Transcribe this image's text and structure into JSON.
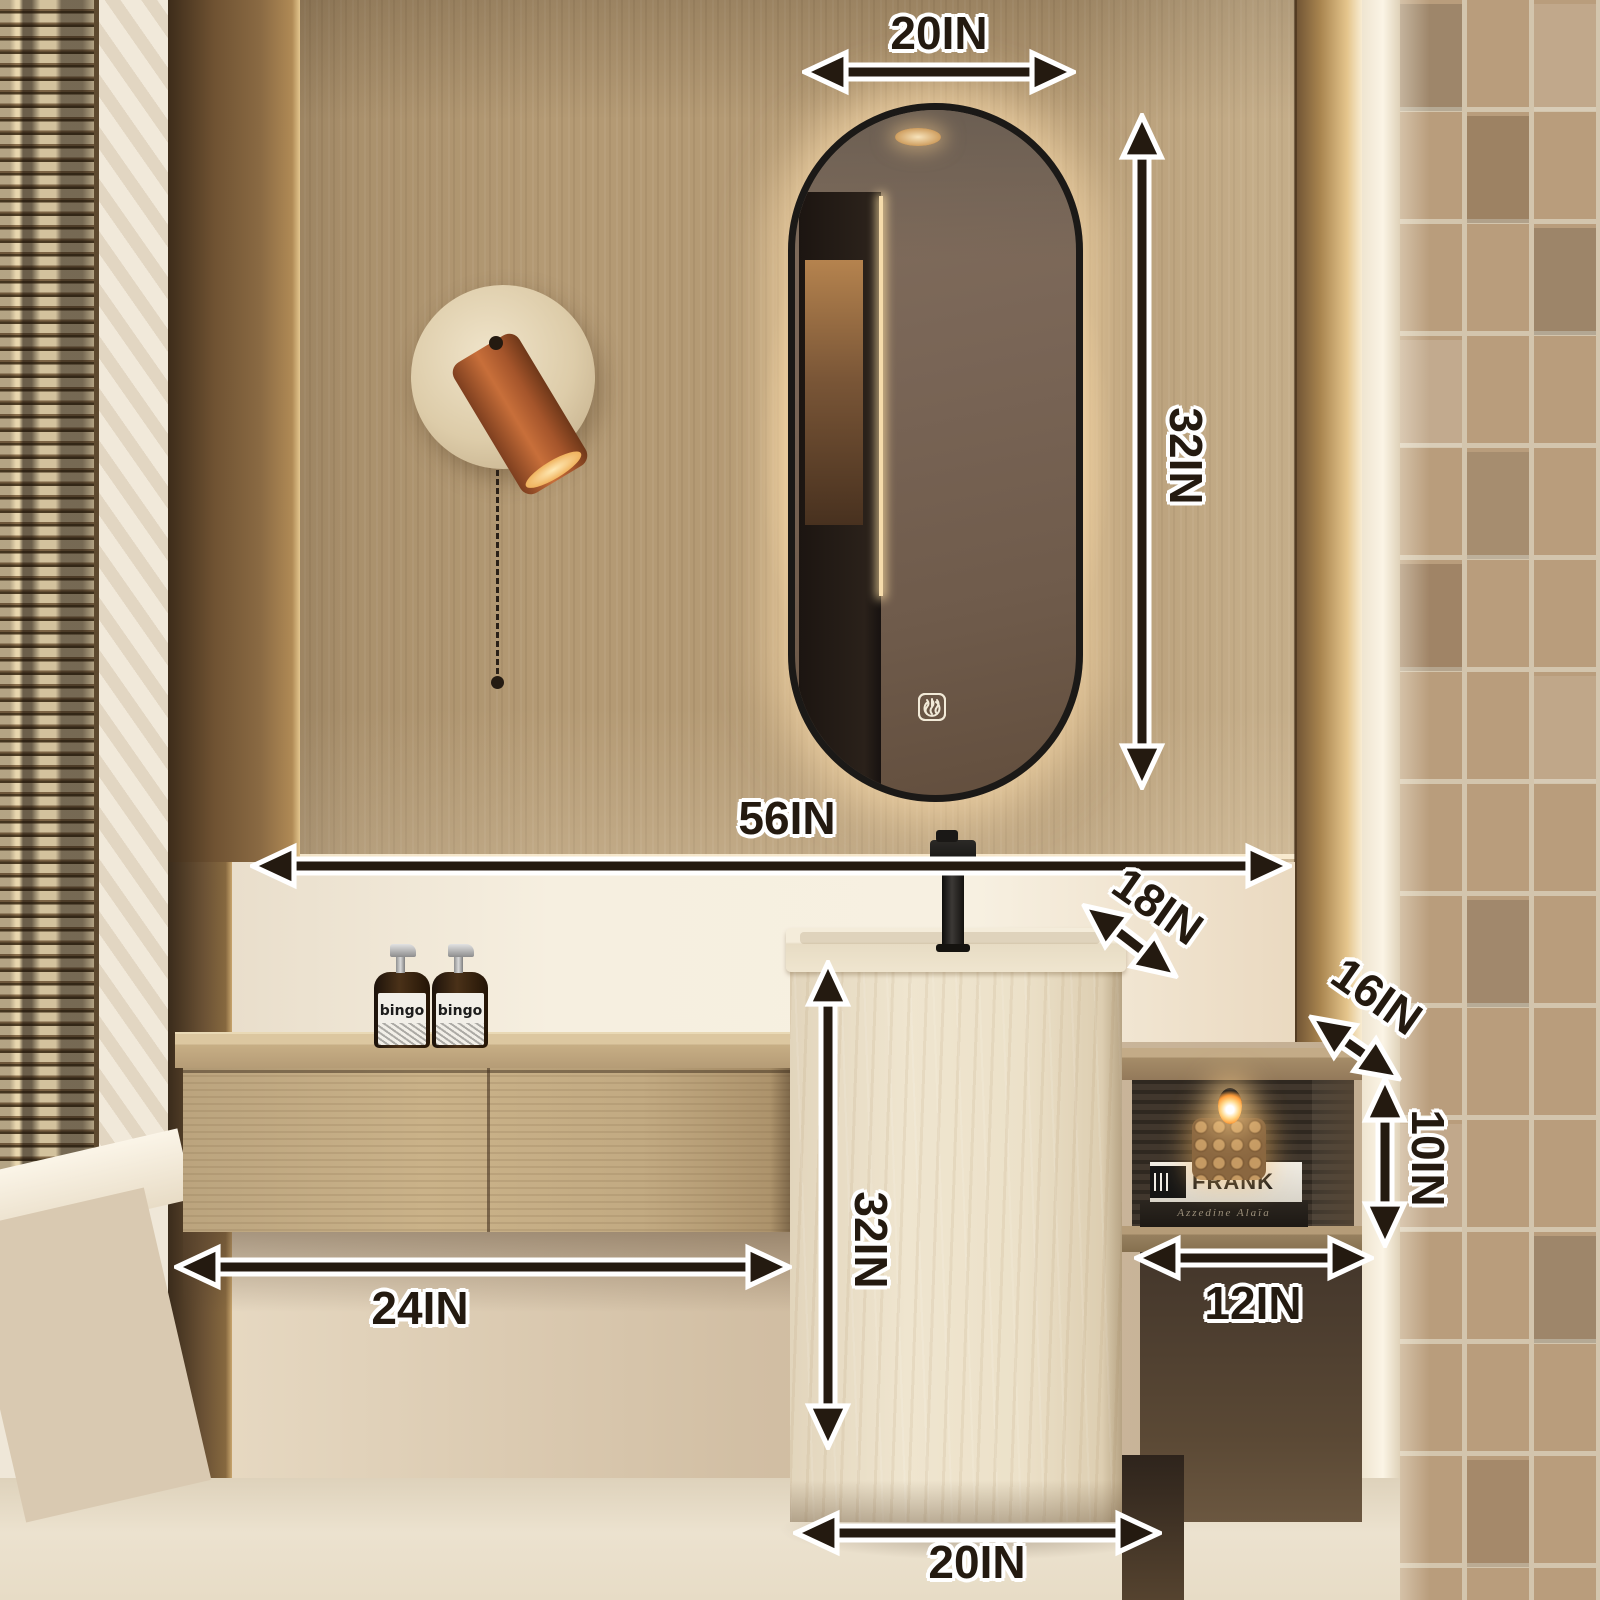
{
  "dimensions": {
    "mirror_width": "20IN",
    "mirror_height": "32IN",
    "wall_span": "56IN",
    "basin_depth": "18IN",
    "shelf_depth": "16IN",
    "shelf_opening_height": "10IN",
    "shelf_width": "12IN",
    "cabinet_width": "24IN",
    "basin_height": "32IN",
    "basin_width": "20IN"
  },
  "products": {
    "soap_label": "bingo",
    "book_title": "FRANK",
    "book_subtitle": "Azzedine Alaïa"
  },
  "mirror_controls": [
    "defogger-icon",
    "power-icon"
  ],
  "colors": {
    "annotation_text": "#241a10",
    "annotation_outline": "#ffffff",
    "wood_wall": "#b49a74",
    "dark_trim": "#5d4730",
    "travertine_basin": "#ece1c9",
    "counter_wood": "#c2aa82",
    "tile_wall": "#b99d7c",
    "lamp_terracotta": "#a5552b",
    "mirror_glass": "#6f5b4b",
    "glow": "#ffe4b2"
  }
}
